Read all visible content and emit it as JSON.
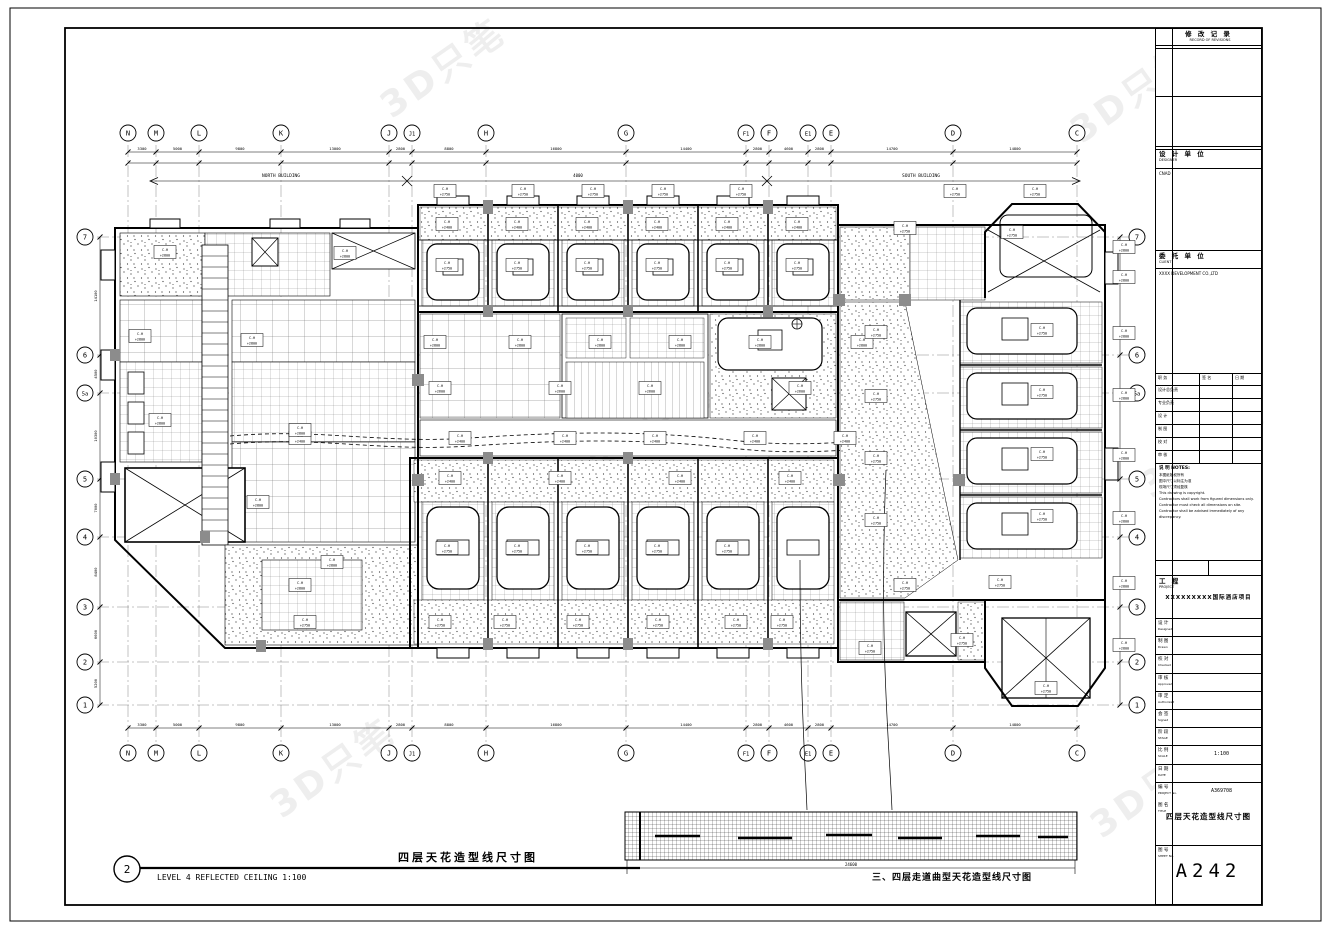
{
  "labels": {
    "plan_number": "2",
    "plan_title_zh": "四层天花造型线尺寸图",
    "plan_title_en": "LEVEL 4 REFLECTED CEILING   1:100",
    "detail_caption": "三、四层走道曲型天花造型线尺寸图",
    "north_building": "NORTH BUILDING",
    "south_building": "SOUTH BUILDING",
    "mid_dim": "4000",
    "detail_dim": "24600",
    "watermark": "3D只笔"
  },
  "grid": {
    "top": [
      {
        "l": "N",
        "x": 128
      },
      {
        "l": "M",
        "x": 156
      },
      {
        "l": "L",
        "x": 199
      },
      {
        "l": "K",
        "x": 281
      },
      {
        "l": "J",
        "x": 389
      },
      {
        "l": "J1",
        "x": 412
      },
      {
        "l": "H",
        "x": 486
      },
      {
        "l": "G",
        "x": 626
      },
      {
        "l": "F1",
        "x": 746
      },
      {
        "l": "F",
        "x": 769
      },
      {
        "l": "E1",
        "x": 808
      },
      {
        "l": "E",
        "x": 831
      },
      {
        "l": "D",
        "x": 953
      },
      {
        "l": "C",
        "x": 1077
      }
    ],
    "left": [
      {
        "l": "7",
        "y": 237
      },
      {
        "l": "6",
        "y": 355
      },
      {
        "l": "5a",
        "y": 393
      },
      {
        "l": "5",
        "y": 479
      },
      {
        "l": "4",
        "y": 537
      },
      {
        "l": "3",
        "y": 607
      },
      {
        "l": "2",
        "y": 662
      },
      {
        "l": "1",
        "y": 705
      }
    ],
    "dims_top": [
      "3300",
      "5000",
      "9800",
      "13000",
      "2800",
      "8800",
      "16800",
      "14400",
      "2800",
      "4600",
      "2800",
      "14700",
      "14800"
    ],
    "dims_bottom": [
      "3300",
      "5000",
      "9800",
      "13000",
      "2800",
      "8800",
      "16800",
      "14400",
      "2800",
      "4600",
      "2800",
      "14700",
      "14800"
    ],
    "dims_left": [
      "14100",
      "4500",
      "10300",
      "7000",
      "8400",
      "6600",
      "5200"
    ]
  },
  "plan": {
    "ch_prefix": "C.H",
    "ch_labels": [
      [
        445,
        191,
        "+2750"
      ],
      [
        523,
        191,
        "+2750"
      ],
      [
        593,
        191,
        "+2750"
      ],
      [
        663,
        191,
        "+2750"
      ],
      [
        741,
        191,
        "+2750"
      ],
      [
        955,
        191,
        "+2750"
      ],
      [
        1035,
        191,
        "+2750"
      ],
      [
        447,
        224,
        "+2400"
      ],
      [
        517,
        224,
        "+2400"
      ],
      [
        587,
        224,
        "+2400"
      ],
      [
        657,
        224,
        "+2400"
      ],
      [
        727,
        224,
        "+2400"
      ],
      [
        797,
        224,
        "+2400"
      ],
      [
        447,
        265,
        "+2750"
      ],
      [
        517,
        265,
        "+2750"
      ],
      [
        587,
        265,
        "+2750"
      ],
      [
        657,
        265,
        "+2750"
      ],
      [
        727,
        265,
        "+2750"
      ],
      [
        797,
        265,
        "+2750"
      ],
      [
        435,
        342,
        "+2800"
      ],
      [
        520,
        342,
        "+2800"
      ],
      [
        600,
        342,
        "+2800"
      ],
      [
        680,
        342,
        "+2800"
      ],
      [
        760,
        342,
        "+2800"
      ],
      [
        862,
        342,
        "+2800"
      ],
      [
        440,
        388,
        "+2600"
      ],
      [
        560,
        388,
        "+2600"
      ],
      [
        650,
        388,
        "+2600"
      ],
      [
        800,
        388,
        "+2600"
      ],
      [
        300,
        438,
        "+2400"
      ],
      [
        460,
        438,
        "+2400"
      ],
      [
        565,
        438,
        "+2400"
      ],
      [
        655,
        438,
        "+2400"
      ],
      [
        755,
        438,
        "+2400"
      ],
      [
        845,
        438,
        "+2400"
      ],
      [
        450,
        478,
        "+2400"
      ],
      [
        560,
        478,
        "+2400"
      ],
      [
        680,
        478,
        "+2400"
      ],
      [
        790,
        478,
        "+2400"
      ],
      [
        447,
        548,
        "+2750"
      ],
      [
        517,
        548,
        "+2750"
      ],
      [
        587,
        548,
        "+2750"
      ],
      [
        657,
        548,
        "+2750"
      ],
      [
        727,
        548,
        "+2750"
      ],
      [
        305,
        622,
        "+2750"
      ],
      [
        440,
        622,
        "+2750"
      ],
      [
        505,
        622,
        "+2750"
      ],
      [
        578,
        622,
        "+2750"
      ],
      [
        658,
        622,
        "+2750"
      ],
      [
        736,
        622,
        "+2750"
      ],
      [
        782,
        622,
        "+2750"
      ],
      [
        165,
        252,
        "+2800"
      ],
      [
        345,
        253,
        "+2800"
      ],
      [
        140,
        336,
        "+2800"
      ],
      [
        252,
        340,
        "+2800"
      ],
      [
        160,
        420,
        "+2800"
      ],
      [
        300,
        430,
        "+2800"
      ],
      [
        258,
        502,
        "+2800"
      ],
      [
        332,
        562,
        "+2800"
      ],
      [
        300,
        585,
        "+2800"
      ],
      [
        905,
        228,
        "+2750"
      ],
      [
        1012,
        232,
        "+2750"
      ],
      [
        876,
        332,
        "+2750"
      ],
      [
        1042,
        330,
        "+2750"
      ],
      [
        876,
        396,
        "+2750"
      ],
      [
        1042,
        392,
        "+2750"
      ],
      [
        876,
        458,
        "+2750"
      ],
      [
        1042,
        454,
        "+2750"
      ],
      [
        876,
        520,
        "+2750"
      ],
      [
        1042,
        516,
        "+2750"
      ],
      [
        905,
        585,
        "+2750"
      ],
      [
        1000,
        582,
        "+2750"
      ],
      [
        870,
        648,
        "+2750"
      ],
      [
        962,
        640,
        "+2750"
      ],
      [
        1046,
        688,
        "+2750"
      ],
      [
        1124,
        247,
        "+2800"
      ],
      [
        1124,
        277,
        "+2800"
      ],
      [
        1124,
        333,
        "+2800"
      ],
      [
        1124,
        395,
        "+2800"
      ],
      [
        1124,
        455,
        "+2800"
      ],
      [
        1124,
        518,
        "+2800"
      ],
      [
        1124,
        583,
        "+2800"
      ],
      [
        1124,
        645,
        "+2800"
      ]
    ]
  },
  "titleblock": {
    "revisions": {
      "zh": "修 改 记 录",
      "en": "RECORD OF REVISIONS"
    },
    "designer": {
      "zh": "设 计 单 位",
      "en": "DESIGNER",
      "name": "CNAD"
    },
    "client": {
      "zh": "委 托 单 位",
      "en": "CLIENT",
      "name": "XXXX DEVELOPMENT CO.,LTD"
    },
    "sign_table": {
      "headers": [
        "职 务",
        "签 名",
        "日 期"
      ],
      "rows": [
        "设计总负责",
        "专业负责",
        "设 计",
        "制 图",
        "校 对",
        "审 核"
      ]
    },
    "notes_title": "说 明 NOTES:",
    "notes": [
      "本图纸版权所有",
      "图中尺寸以标注为准",
      "现场尺寸须经复核",
      "This drawing is copyright.",
      "Contractors shall work from figured dimensions only.",
      "Contractor must check all dimensions on site.",
      "Contractor shall be advised immediately of any discrepancy."
    ],
    "mini": {
      "a": "",
      "b": ""
    },
    "project": {
      "zh": "工 程",
      "en": "PROJECT",
      "name": "XXXXXXXXX国际酒店项目"
    },
    "fields": [
      {
        "zh": "设 计",
        "en": "Designed",
        "v": ""
      },
      {
        "zh": "制 图",
        "en": "Drawn",
        "v": ""
      },
      {
        "zh": "校 对",
        "en": "Checked",
        "v": ""
      },
      {
        "zh": "审 核",
        "en": "Approved",
        "v": ""
      },
      {
        "zh": "审 定",
        "en": "Authorized",
        "v": ""
      },
      {
        "zh": "会 签",
        "en": "Signed",
        "v": ""
      },
      {
        "zh": "阶 段",
        "en": "STAGE",
        "v": ""
      },
      {
        "zh": "比 例",
        "en": "SCALE",
        "v": "1:100"
      },
      {
        "zh": "日 期",
        "en": "DATE",
        "v": ""
      },
      {
        "zh": "编 号",
        "en": "PROJECT No.",
        "v": "A369708"
      }
    ],
    "title_field": {
      "zh": "图 名",
      "en": "TITLE",
      "value": "四层天花造型线尺寸图"
    },
    "sheet_field": {
      "zh": "图 号",
      "en": "SHEET No.",
      "value": "A242"
    }
  }
}
